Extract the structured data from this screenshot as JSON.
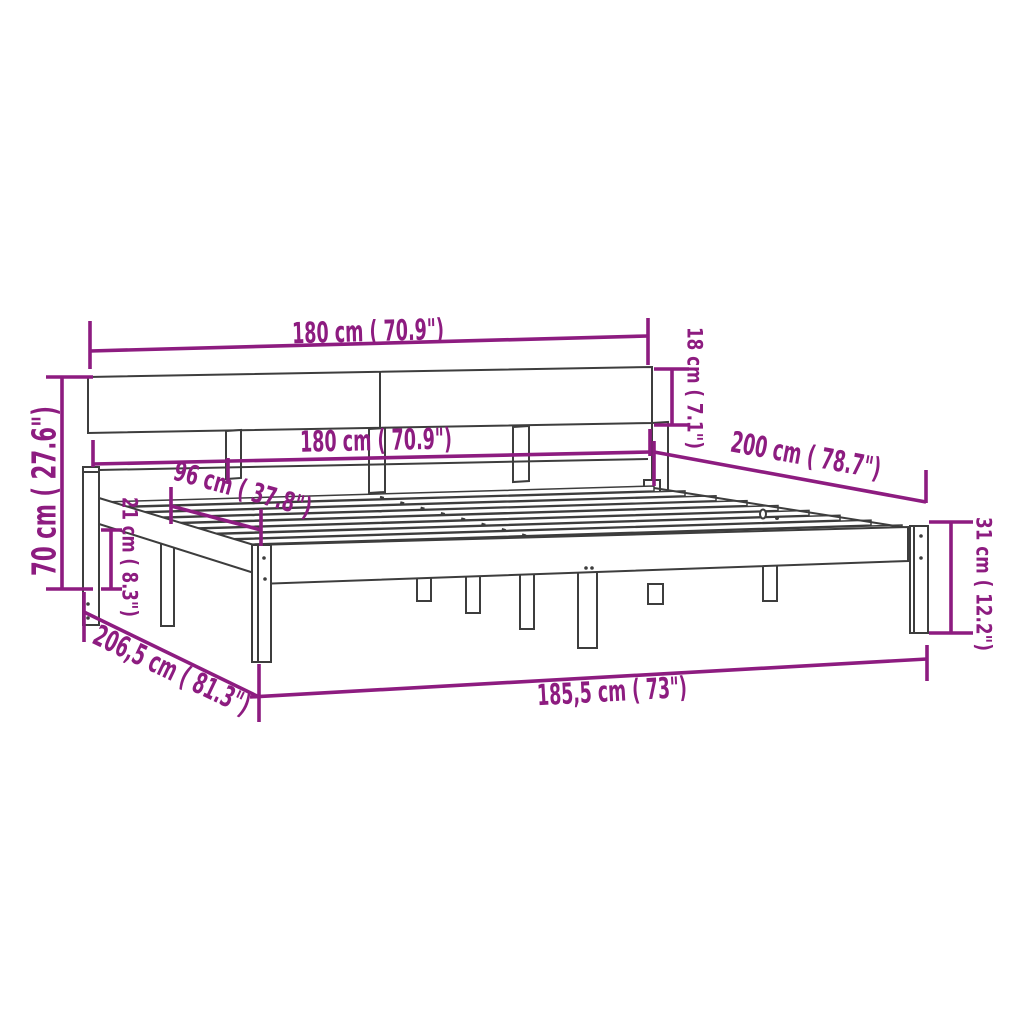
{
  "diagram": {
    "subject": "bed-frame-with-headboard-dimension-drawing",
    "background_color": "#ffffff",
    "dimension_color": "#8D1C80",
    "drawing_color": "#3d3d3d"
  },
  "dimensions": {
    "headboard_width_top": "180 cm ( 70.9\")",
    "frame_inner_width": "180 cm ( 70.9\")",
    "headboard_board_height": "18 cm ( 7.1\")",
    "frame_length": "200 cm ( 78.7\")",
    "headboard_total_height": "70 cm ( 27.6\")",
    "slat_base_width": "96 cm ( 37.8\")",
    "side_rail_height": "21 cm ( 8.3\")",
    "leg_height": "31 cm ( 12.2\")",
    "total_length": "206,5 cm ( 81.3\")",
    "total_width": "185,5 cm ( 73\")"
  }
}
